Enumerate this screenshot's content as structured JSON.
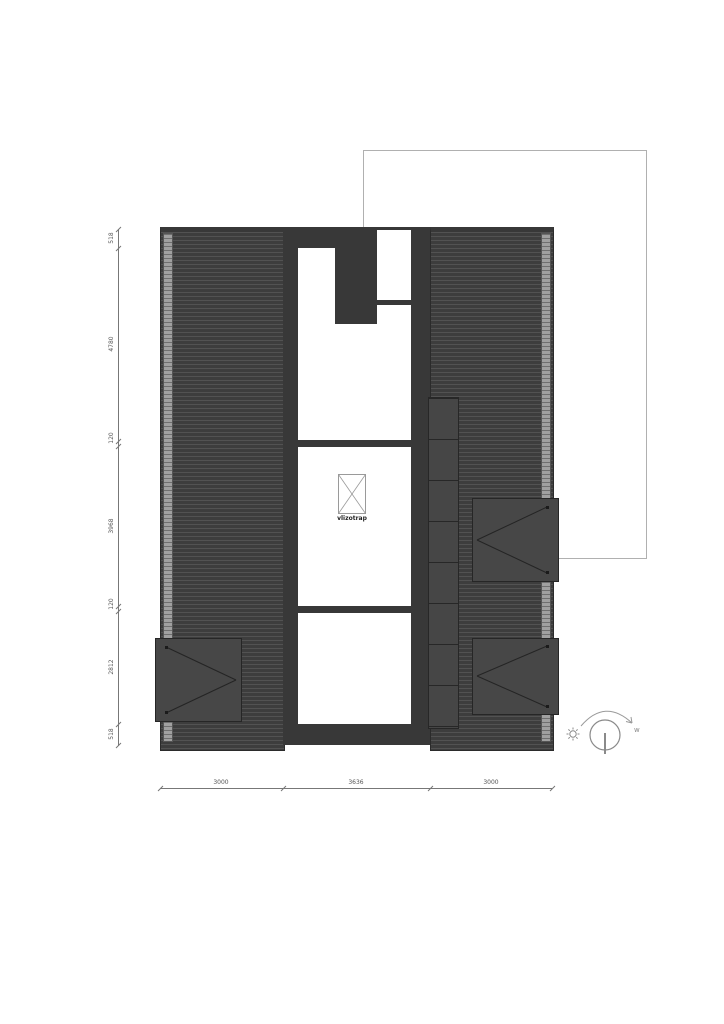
{
  "plan": {
    "title_hint": "roof plan drawing",
    "attic_ladder_label": "vlizotrap",
    "colors": {
      "roof_dark": "#3d3d3d",
      "roof_seam_line": "#525252",
      "wall_solid": "#383838",
      "skylight_fill": "#474747",
      "plot_outline": "#b0b0b0",
      "dimension_gray": "#777777",
      "paper": "#ffffff"
    }
  },
  "dimensions": {
    "left": [
      "518",
      "4780",
      "120",
      "3968",
      "120",
      "2812",
      "518"
    ],
    "bottom": [
      "3000",
      "3636",
      "3000"
    ]
  },
  "orientation": {
    "west_label": "w",
    "sun_icon": "sun",
    "arc_icon": "sun-path-arrow"
  }
}
